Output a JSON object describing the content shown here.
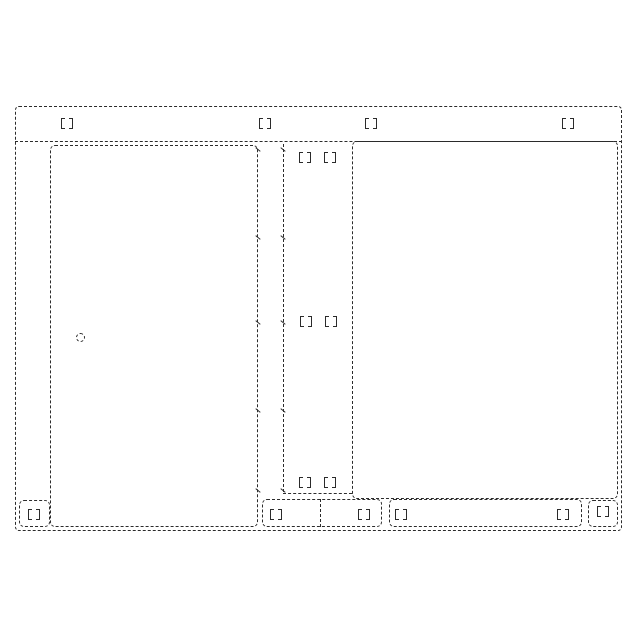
{
  "figure": {
    "description": "design-patent broken-line front elevation of cabinet appliance",
    "background_color": "#ffffff",
    "line_color": "#2b2b2b",
    "canvas": {
      "width": 640,
      "height": 640
    },
    "rects": [
      {
        "name": "outer-cabinet-outline",
        "x": 15,
        "y": 106,
        "w": 607,
        "h": 425,
        "r": 4
      },
      {
        "name": "left-door-panel",
        "x": 50,
        "y": 145,
        "w": 208,
        "h": 382,
        "r": 5
      },
      {
        "name": "right-panel",
        "x": 352,
        "y": 141,
        "w": 266,
        "h": 358,
        "r": 5
      },
      {
        "name": "bottom-compartment-left",
        "x": 262,
        "y": 499,
        "w": 120,
        "h": 28,
        "r": 5
      },
      {
        "name": "bottom-compartment-right",
        "x": 389,
        "y": 499,
        "w": 193,
        "h": 28,
        "r": 5
      },
      {
        "name": "left-foot",
        "x": 19,
        "y": 500,
        "w": 31,
        "h": 27,
        "r": 5
      },
      {
        "name": "right-foot",
        "x": 588,
        "y": 500,
        "w": 30,
        "h": 27,
        "r": 5
      }
    ],
    "lines": [
      {
        "name": "top-rail-line",
        "orient": "h",
        "x": 15,
        "y": 141,
        "len": 607
      },
      {
        "name": "hinge-strip-line",
        "orient": "v",
        "x": 283,
        "y": 144,
        "len": 348
      },
      {
        "name": "center-column-bottom-line",
        "orient": "h",
        "x": 283,
        "y": 493,
        "len": 69
      },
      {
        "name": "bottom-compartment-divider",
        "orient": "v",
        "x": 320,
        "y": 499,
        "len": 28
      }
    ],
    "brackets": [
      {
        "name": "top-rail-bracket-1",
        "cx": 67,
        "cy": 123
      },
      {
        "name": "top-rail-bracket-2",
        "cx": 265,
        "cy": 123
      },
      {
        "name": "top-rail-bracket-3",
        "cx": 371,
        "cy": 123
      },
      {
        "name": "top-rail-bracket-4",
        "cx": 568,
        "cy": 123
      },
      {
        "name": "column-top-bracket-left",
        "cx": 305,
        "cy": 157
      },
      {
        "name": "column-top-bracket-right",
        "cx": 330,
        "cy": 157
      },
      {
        "name": "column-mid-bracket-left",
        "cx": 306,
        "cy": 321
      },
      {
        "name": "column-mid-bracket-right",
        "cx": 331,
        "cy": 321
      },
      {
        "name": "column-bottom-bracket-left",
        "cx": 305,
        "cy": 482
      },
      {
        "name": "column-bottom-bracket-right",
        "cx": 330,
        "cy": 482
      },
      {
        "name": "bottom-band-bracket-1",
        "cx": 276,
        "cy": 514
      },
      {
        "name": "bottom-band-bracket-2",
        "cx": 364,
        "cy": 514
      },
      {
        "name": "bottom-band-bracket-3",
        "cx": 401,
        "cy": 514
      },
      {
        "name": "bottom-band-bracket-4",
        "cx": 563,
        "cy": 514
      },
      {
        "name": "left-foot-bracket",
        "cx": 34,
        "cy": 514
      },
      {
        "name": "right-foot-bracket",
        "cx": 603,
        "cy": 511
      }
    ],
    "hinge_ticks": [
      {
        "x": 258,
        "y": 149
      },
      {
        "x": 283,
        "y": 149
      },
      {
        "x": 258,
        "y": 237
      },
      {
        "x": 283,
        "y": 237
      },
      {
        "x": 258,
        "y": 322
      },
      {
        "x": 283,
        "y": 322
      },
      {
        "x": 258,
        "y": 410
      },
      {
        "x": 283,
        "y": 410
      },
      {
        "x": 258,
        "y": 490
      },
      {
        "x": 283,
        "y": 490
      }
    ],
    "keyhole": {
      "name": "door-lock-keyhole",
      "cx": 80,
      "cy": 337,
      "d": 9
    }
  }
}
